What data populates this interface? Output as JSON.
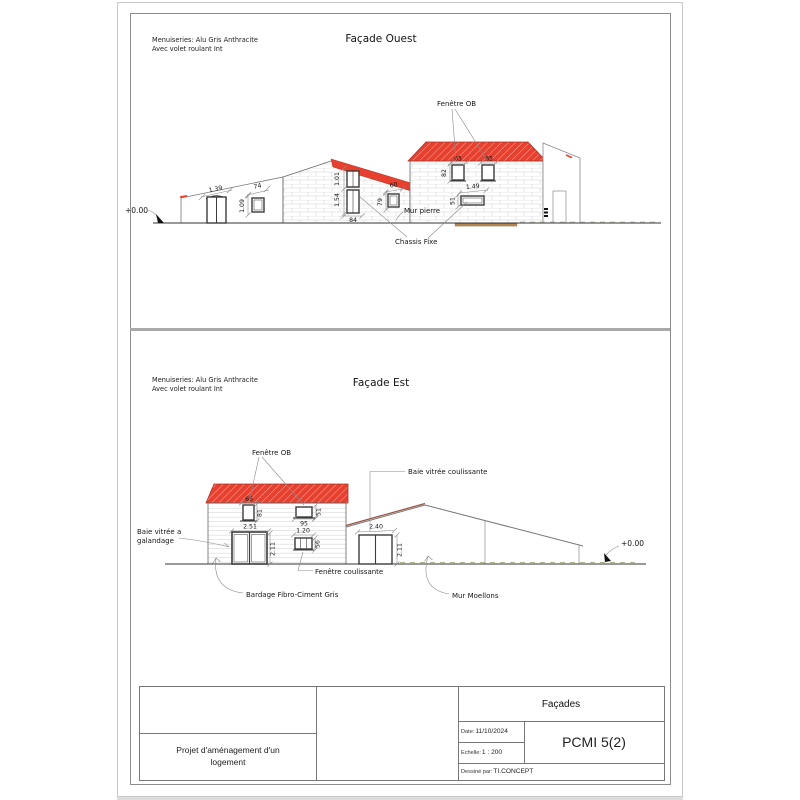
{
  "notes": {
    "line1": "Menuiseries: Alu Gris Anthracite",
    "line2": "Avec volet roulant Int"
  },
  "west": {
    "title": "Façade Ouest",
    "level": "+0.00",
    "labels": {
      "fenetre_ob": "Fenêtre OB",
      "mur_pierre": "Mur pierre",
      "chassis_fixe": "Chassis Fixe"
    },
    "dims": {
      "door_w": "1.39",
      "win_w": "74",
      "win_h": "1.09",
      "stack_upper": "1.01",
      "stack_total": "1.54",
      "stack_w": "84",
      "small_w": "60",
      "small_h": "79",
      "attic_w1": "65",
      "attic_w2": "65",
      "attic_h": "82",
      "fixed_w": "1.49",
      "fixed_h": "51"
    }
  },
  "east": {
    "title": "Façade Est",
    "level": "+0.00",
    "labels": {
      "fenetre_ob": "Fenêtre OB",
      "baie_coulissante": "Baie vitrée coulissante",
      "baie_galandage_l1": "Baie vitrée a",
      "baie_galandage_l2": "galandage",
      "fenetre_coulissante": "Fenêtre coulissante",
      "bardage": "Bardage Fibro-Ciment Gris",
      "mur_moellons": "Mur Moellons"
    },
    "dims": {
      "ob_w": "66",
      "ob_h": "81",
      "top_w": "95",
      "top_h": "51",
      "bay1_w": "2.51",
      "bay1_h": "2.11",
      "slider_w": "1.20",
      "slider_h": "56",
      "bay2_w": "2.40",
      "bay2_h": "2.11"
    }
  },
  "titleblock": {
    "project_l1": "Projet d'aménagement d'un",
    "project_l2": "logement",
    "sheet": "Façades",
    "date_label": "Date:",
    "date_value": "11/10/2024",
    "scale_label": "Echelle:",
    "scale_value": "1 : 200",
    "author_label": "Dessiné par:",
    "author_value": "TI.CONCEPT",
    "code": "PCMI 5(2)"
  },
  "colors": {
    "roof_red": "#e8402f",
    "roof_hatch_line": "#f4a298",
    "moellons_edge": "#9b5545",
    "terrace_tan": "#b5854f"
  }
}
